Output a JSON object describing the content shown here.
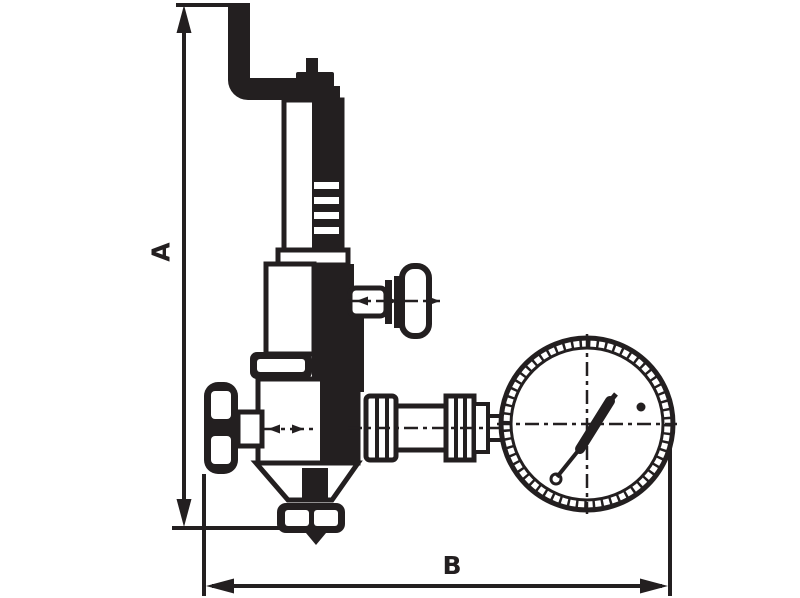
{
  "diagram": {
    "kind": "technical dimensional line drawing",
    "subject": "spring safety valve with exhaust elbow pipe, side test handle, inlet handwheel and pressure gauge",
    "dimensions": {
      "vertical_label": "A",
      "horizontal_label": "B"
    },
    "colors": {
      "line": "#231f20",
      "background": "#ffffff"
    }
  }
}
